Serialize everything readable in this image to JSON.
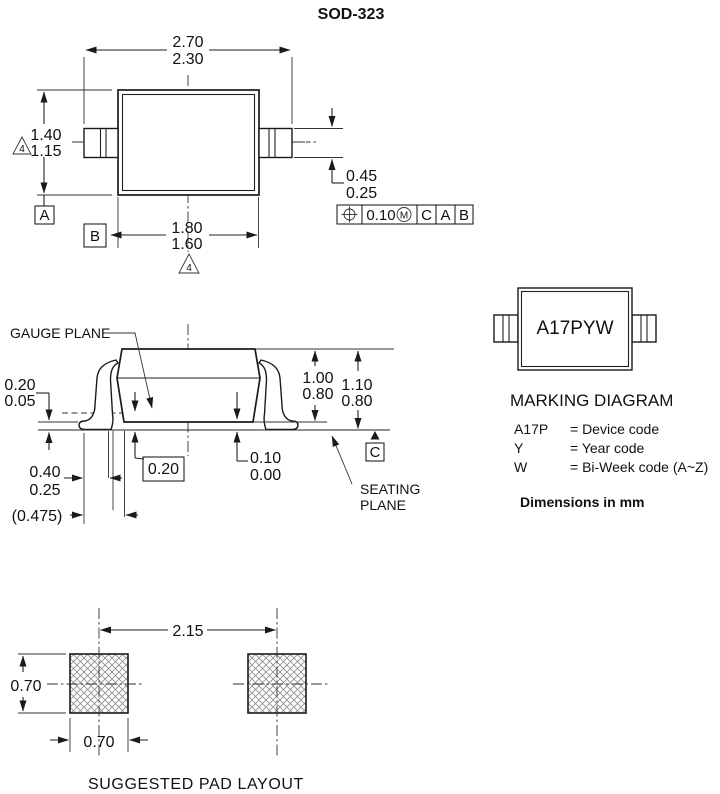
{
  "title": "SOD-323",
  "top_view": {
    "dim_overall_max": "2.70",
    "dim_overall_min": "2.30",
    "dim_height_max": "1.40",
    "dim_height_min": "1.15",
    "dim_body_max": "1.80",
    "dim_body_min": "1.60",
    "dim_lead_max": "0.45",
    "dim_lead_min": "0.25",
    "note_flag": "4",
    "datum_a": "A",
    "datum_b": "B",
    "fcf": {
      "tolerance": "0.10",
      "modifier": "M",
      "datum_1": "C",
      "datum_2": "A",
      "datum_3": "B"
    }
  },
  "side_view": {
    "gauge_plane_label": "GAUGE PLANE",
    "seating_plane_label_line1": "SEATING",
    "seating_plane_label_line2": "PLANE",
    "datum_c": "C",
    "dim_lead_thickness_max": "0.20",
    "dim_lead_thickness_min": "0.05",
    "dim_foot_length_max": "0.40",
    "dim_foot_length_min": "0.25",
    "dim_reference": "(0.475)",
    "dim_gauge_height": "0.20",
    "dim_standoff_max": "0.10",
    "dim_standoff_min": "0.00",
    "dim_body_height_max": "1.00",
    "dim_body_height_min": "0.80",
    "dim_total_height_max": "1.10",
    "dim_total_height_min": "0.80"
  },
  "marking": {
    "code": "A17PYW",
    "heading": "MARKING DIAGRAM",
    "legend": [
      {
        "key": "A17P",
        "value": "= Device code"
      },
      {
        "key": "Y",
        "value": "= Year code"
      },
      {
        "key": "W",
        "value": "= Bi-Week code (A~Z)"
      }
    ],
    "units_note": "Dimensions in mm"
  },
  "pad_layout": {
    "dim_pitch": "2.15",
    "dim_pad_height": "0.70",
    "dim_pad_width": "0.70",
    "caption": "SUGGESTED PAD LAYOUT"
  }
}
